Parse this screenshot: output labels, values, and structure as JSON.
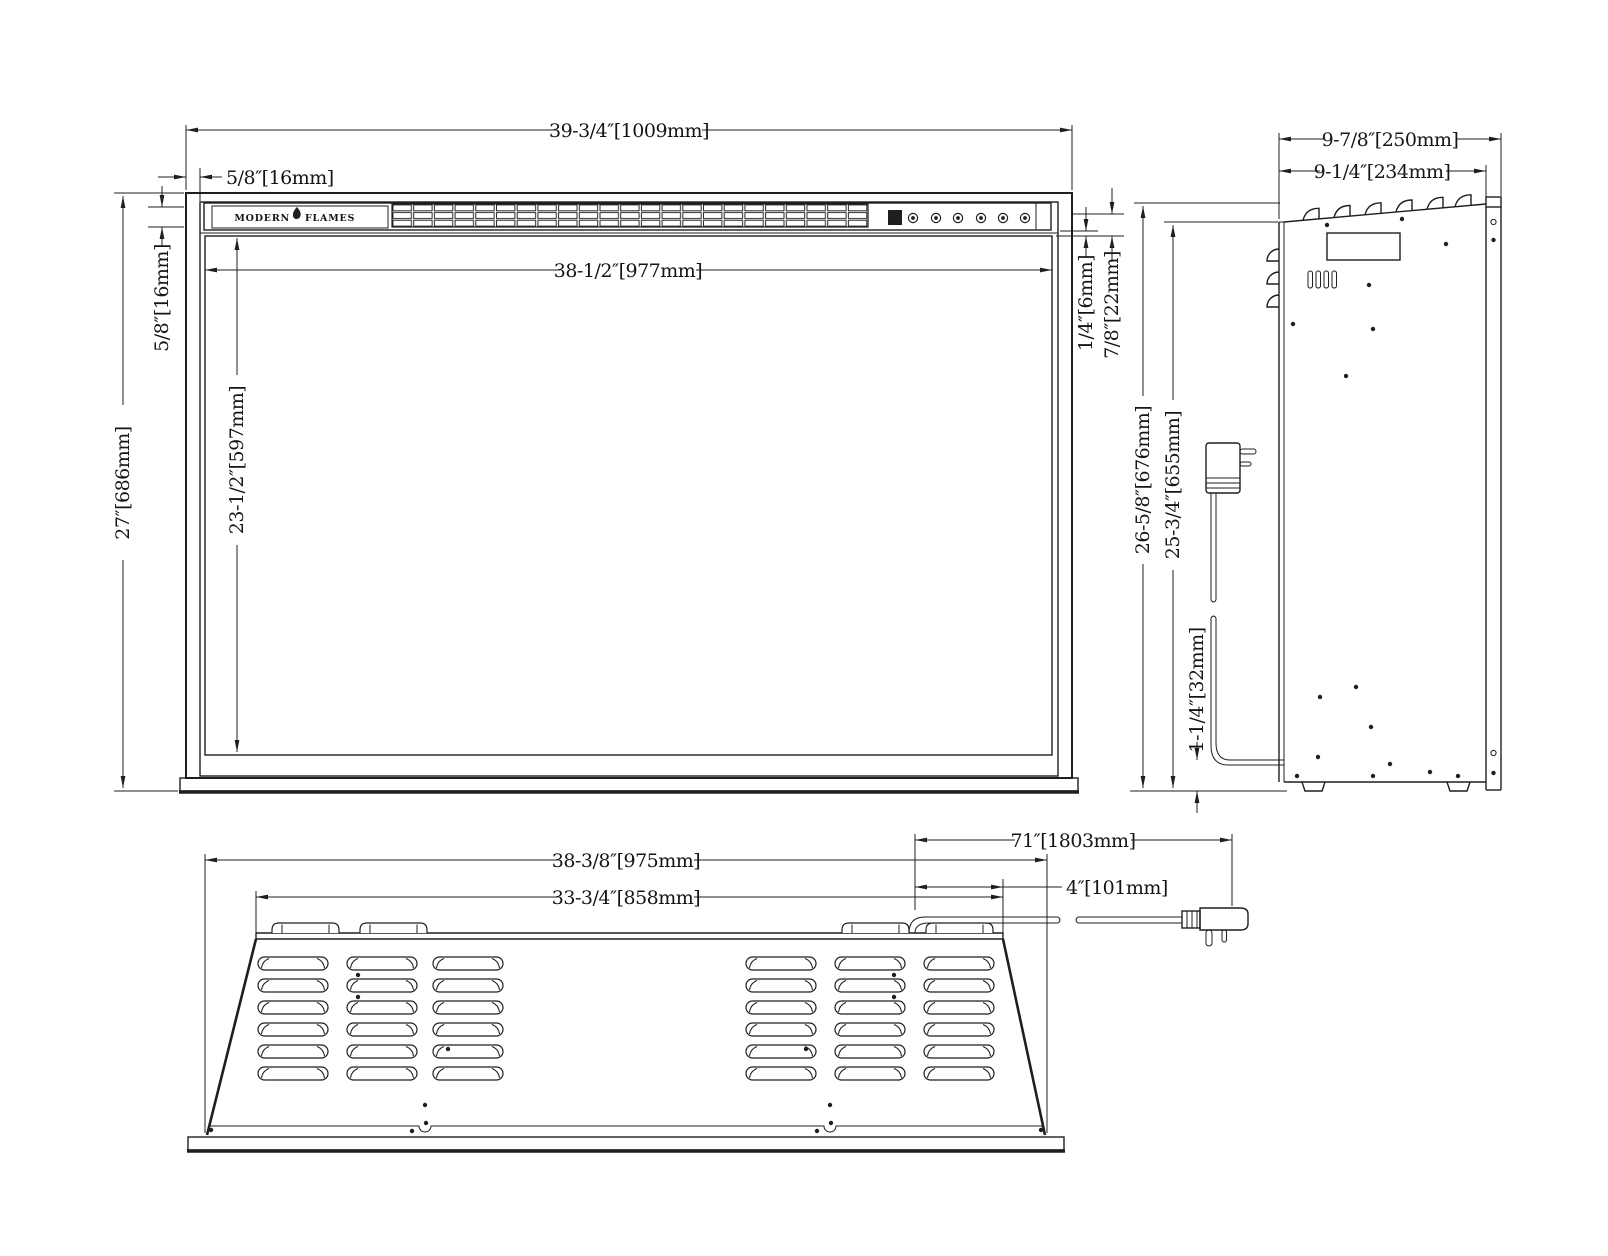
{
  "brand": {
    "modern": "MODERN",
    "flames": "FLAMES"
  },
  "front": {
    "overall_width": "39-3/4″[1009mm]",
    "side_lip": "5/8″[16mm]",
    "glass_width": "38-1/2″[977mm]",
    "top_lip": "5/8″[16mm]",
    "glass_height": "23-1/2″[597mm]",
    "overall_height": "27″[686mm]",
    "glass_reveal": "1/4″[6mm]",
    "trim_height": "7/8″[22mm]"
  },
  "side": {
    "overall_depth": "9-7/8″[250mm]",
    "body_depth": "9-1/4″[234mm]",
    "overall_height": "26-5/8″[676mm]",
    "body_height": "25-3/4″[655mm]",
    "cord_height": "1-1/4″[32mm]"
  },
  "top": {
    "body_width": "38-3/8″[975mm]",
    "vent_span": "33-3/4″[858mm]",
    "cord_length": "71″[1803mm]",
    "cord_offset": "4″[101mm]"
  }
}
